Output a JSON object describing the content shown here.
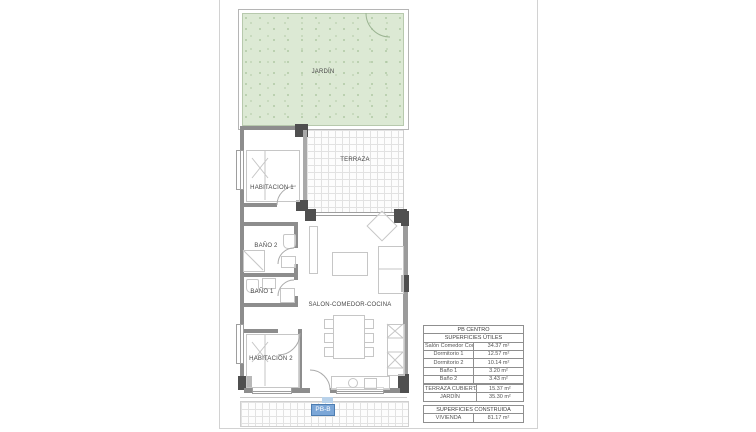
{
  "floor_plan": {
    "unit_label": "PB-B",
    "rooms": {
      "jardin": "JARDÍN",
      "terraza": "TERRAZA",
      "habitacion1": "HABITACION 1",
      "bano2": "BAÑO 2",
      "bano1": "BAÑO 1",
      "salon": "SALON-COMEDOR-COCINA",
      "habitacion2": "HABITACION 2"
    },
    "colors": {
      "garden_fill": "#dce9d4",
      "wall_gray": "#8d8d8d",
      "column_dark": "#4f4f4f",
      "unit_badge_blue": "#7ba6d7"
    }
  },
  "area_table": {
    "title": "PB CENTRO",
    "useful": {
      "header": "SUPERFICIES ÚTILES",
      "rows": [
        [
          "Salón Comedor Cocina",
          "34.37 m²"
        ],
        [
          "Dormitorio 1",
          "12.57 m²"
        ],
        [
          "Dormitorio 2",
          "10.14 m²"
        ],
        [
          "Baño 1",
          "3.20 m²"
        ],
        [
          "Baño 2",
          "3.43 m²"
        ]
      ]
    },
    "exterior": {
      "rows": [
        [
          "TERRAZA CUBIERTA",
          "15.37 m²"
        ],
        [
          "JARDÍN",
          "35.30 m²"
        ]
      ]
    },
    "built": {
      "header": "SUPERFICIES CONSTRUIDA",
      "rows": [
        [
          "VIVIENDA",
          "81.17 m²"
        ]
      ]
    }
  }
}
